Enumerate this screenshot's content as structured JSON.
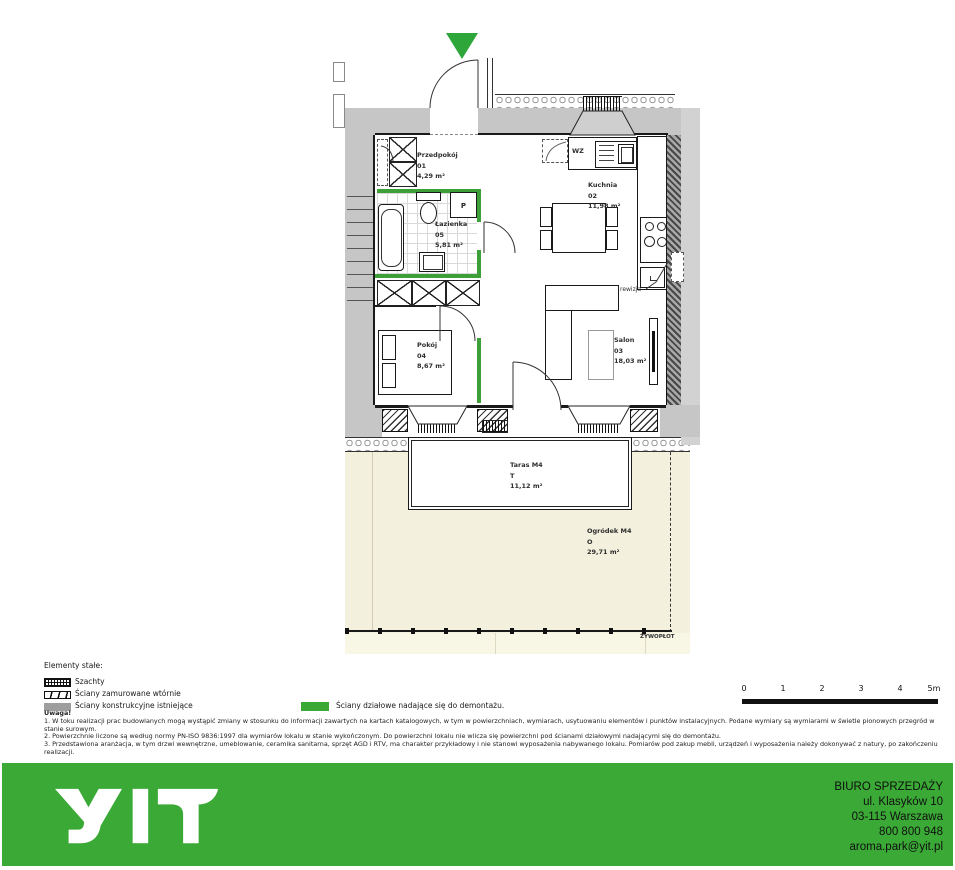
{
  "plan": {
    "rooms": [
      {
        "name": "Przedpokój",
        "number": "01",
        "area": "4,29 m²"
      },
      {
        "name": "Kuchnia",
        "number": "02",
        "area": "11,98 m²"
      },
      {
        "name": "Salon",
        "number": "03",
        "area": "18,03 m²"
      },
      {
        "name": "Pokój",
        "number": "04",
        "area": "8,67 m²"
      },
      {
        "name": "Łazienka",
        "number": "05",
        "area": "5,81 m²"
      },
      {
        "name": "Taras M4",
        "number": "T",
        "area": "11,12 m²"
      },
      {
        "name": "Ogródek M4",
        "number": "O",
        "area": "29,71 m²"
      }
    ],
    "annotations": {
      "wz": "WZ",
      "washer": "P",
      "rewizja": "rewizja",
      "zywoplot": "ŻYWOPŁOT"
    }
  },
  "legend": {
    "title": "Elementy stałe:",
    "items": [
      {
        "label": "Szachty"
      },
      {
        "label": "Ściany zamurowane wtórnie"
      },
      {
        "label": "Ściany konstrukcyjne istniejące"
      },
      {
        "label": "Ściany działowe nadające się do demontażu."
      }
    ]
  },
  "notes": {
    "heading": "Uwaga!",
    "items": [
      "1. W toku realizacji prac budowlanych mogą wystąpić zmiany w stosunku do informacji zawartych na kartach katalogowych, w tym w powierzchniach, wymiarach, usytuowaniu elementów i punktów instalacyjnych. Podane wymiary są wymiarami w świetle pionowych przegród w stanie surowym.",
      "2. Powierzchnie liczone są według normy PN-ISO 9836:1997 dla wymiarów lokalu w stanie wykończonym. Do powierzchni lokalu nie wlicza się powierzchni pod ścianami działowymi nadającymi się do demontażu.",
      "3. Przedstawiona aranżacja, w tym drzwi wewnętrzne, umeblowanie, ceramika sanitarna, sprzęt AGD i RTV, ma charakter przykładowy i nie stanowi wyposażenia nabywanego lokalu. Pomiarów pod zakup mebli, urządzeń i wyposażenia należy dokonywać z natury, po zakończeniu realizacji."
    ]
  },
  "scalebar": {
    "labels": [
      "0",
      "1",
      "2",
      "3",
      "4",
      "5m"
    ]
  },
  "footer": {
    "logo": "YIT",
    "office_lines": [
      "BIURO SPRZEDAŻY",
      "ul. Klasyków 10",
      "03-115 Warszawa",
      "800 800 948",
      "aroma.park@yit.pl"
    ]
  },
  "colors": {
    "brand_green": "#3AA935",
    "partition_green": "#3C9F38",
    "wall_gray": "#C6C6C6",
    "garden_beige": "#F3F1DD"
  }
}
